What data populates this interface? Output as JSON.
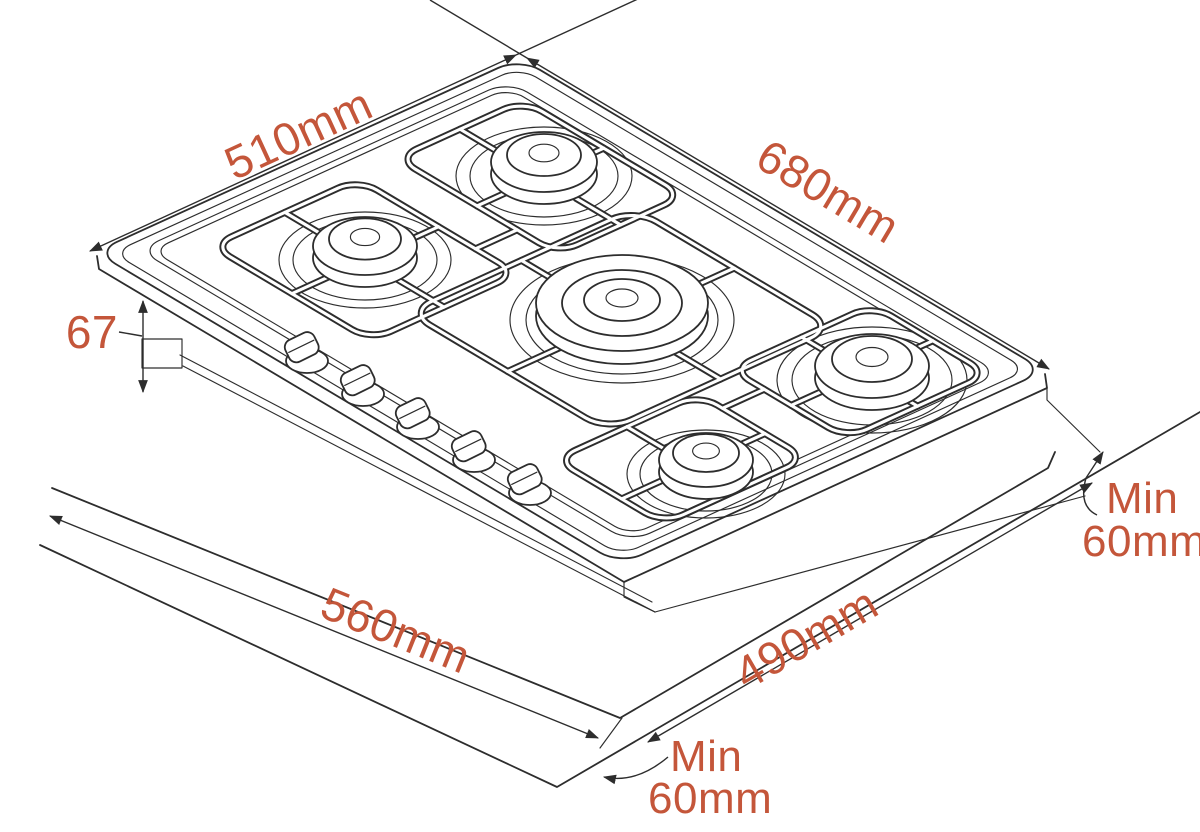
{
  "diagram": {
    "subject": "Gas hob installation dimensions",
    "description": "Isometric line drawing of a 5-burner built-in gas hob shown above its worktop cut-out",
    "style": {
      "background": "#ffffff",
      "line_color": "#2d2d2d",
      "dimension_text_color": "#c4563a"
    },
    "hob": {
      "burner_count": 5,
      "control_knob_count": 5
    },
    "dimensions": {
      "top_left": "510mm",
      "top_right": "680mm",
      "height_left": "67",
      "bottom_left": "560mm",
      "bottom_right": "490mm",
      "clearance_right": [
        "Min",
        "60mm"
      ],
      "clearance_bottom": [
        "Min",
        "60mm"
      ]
    }
  }
}
